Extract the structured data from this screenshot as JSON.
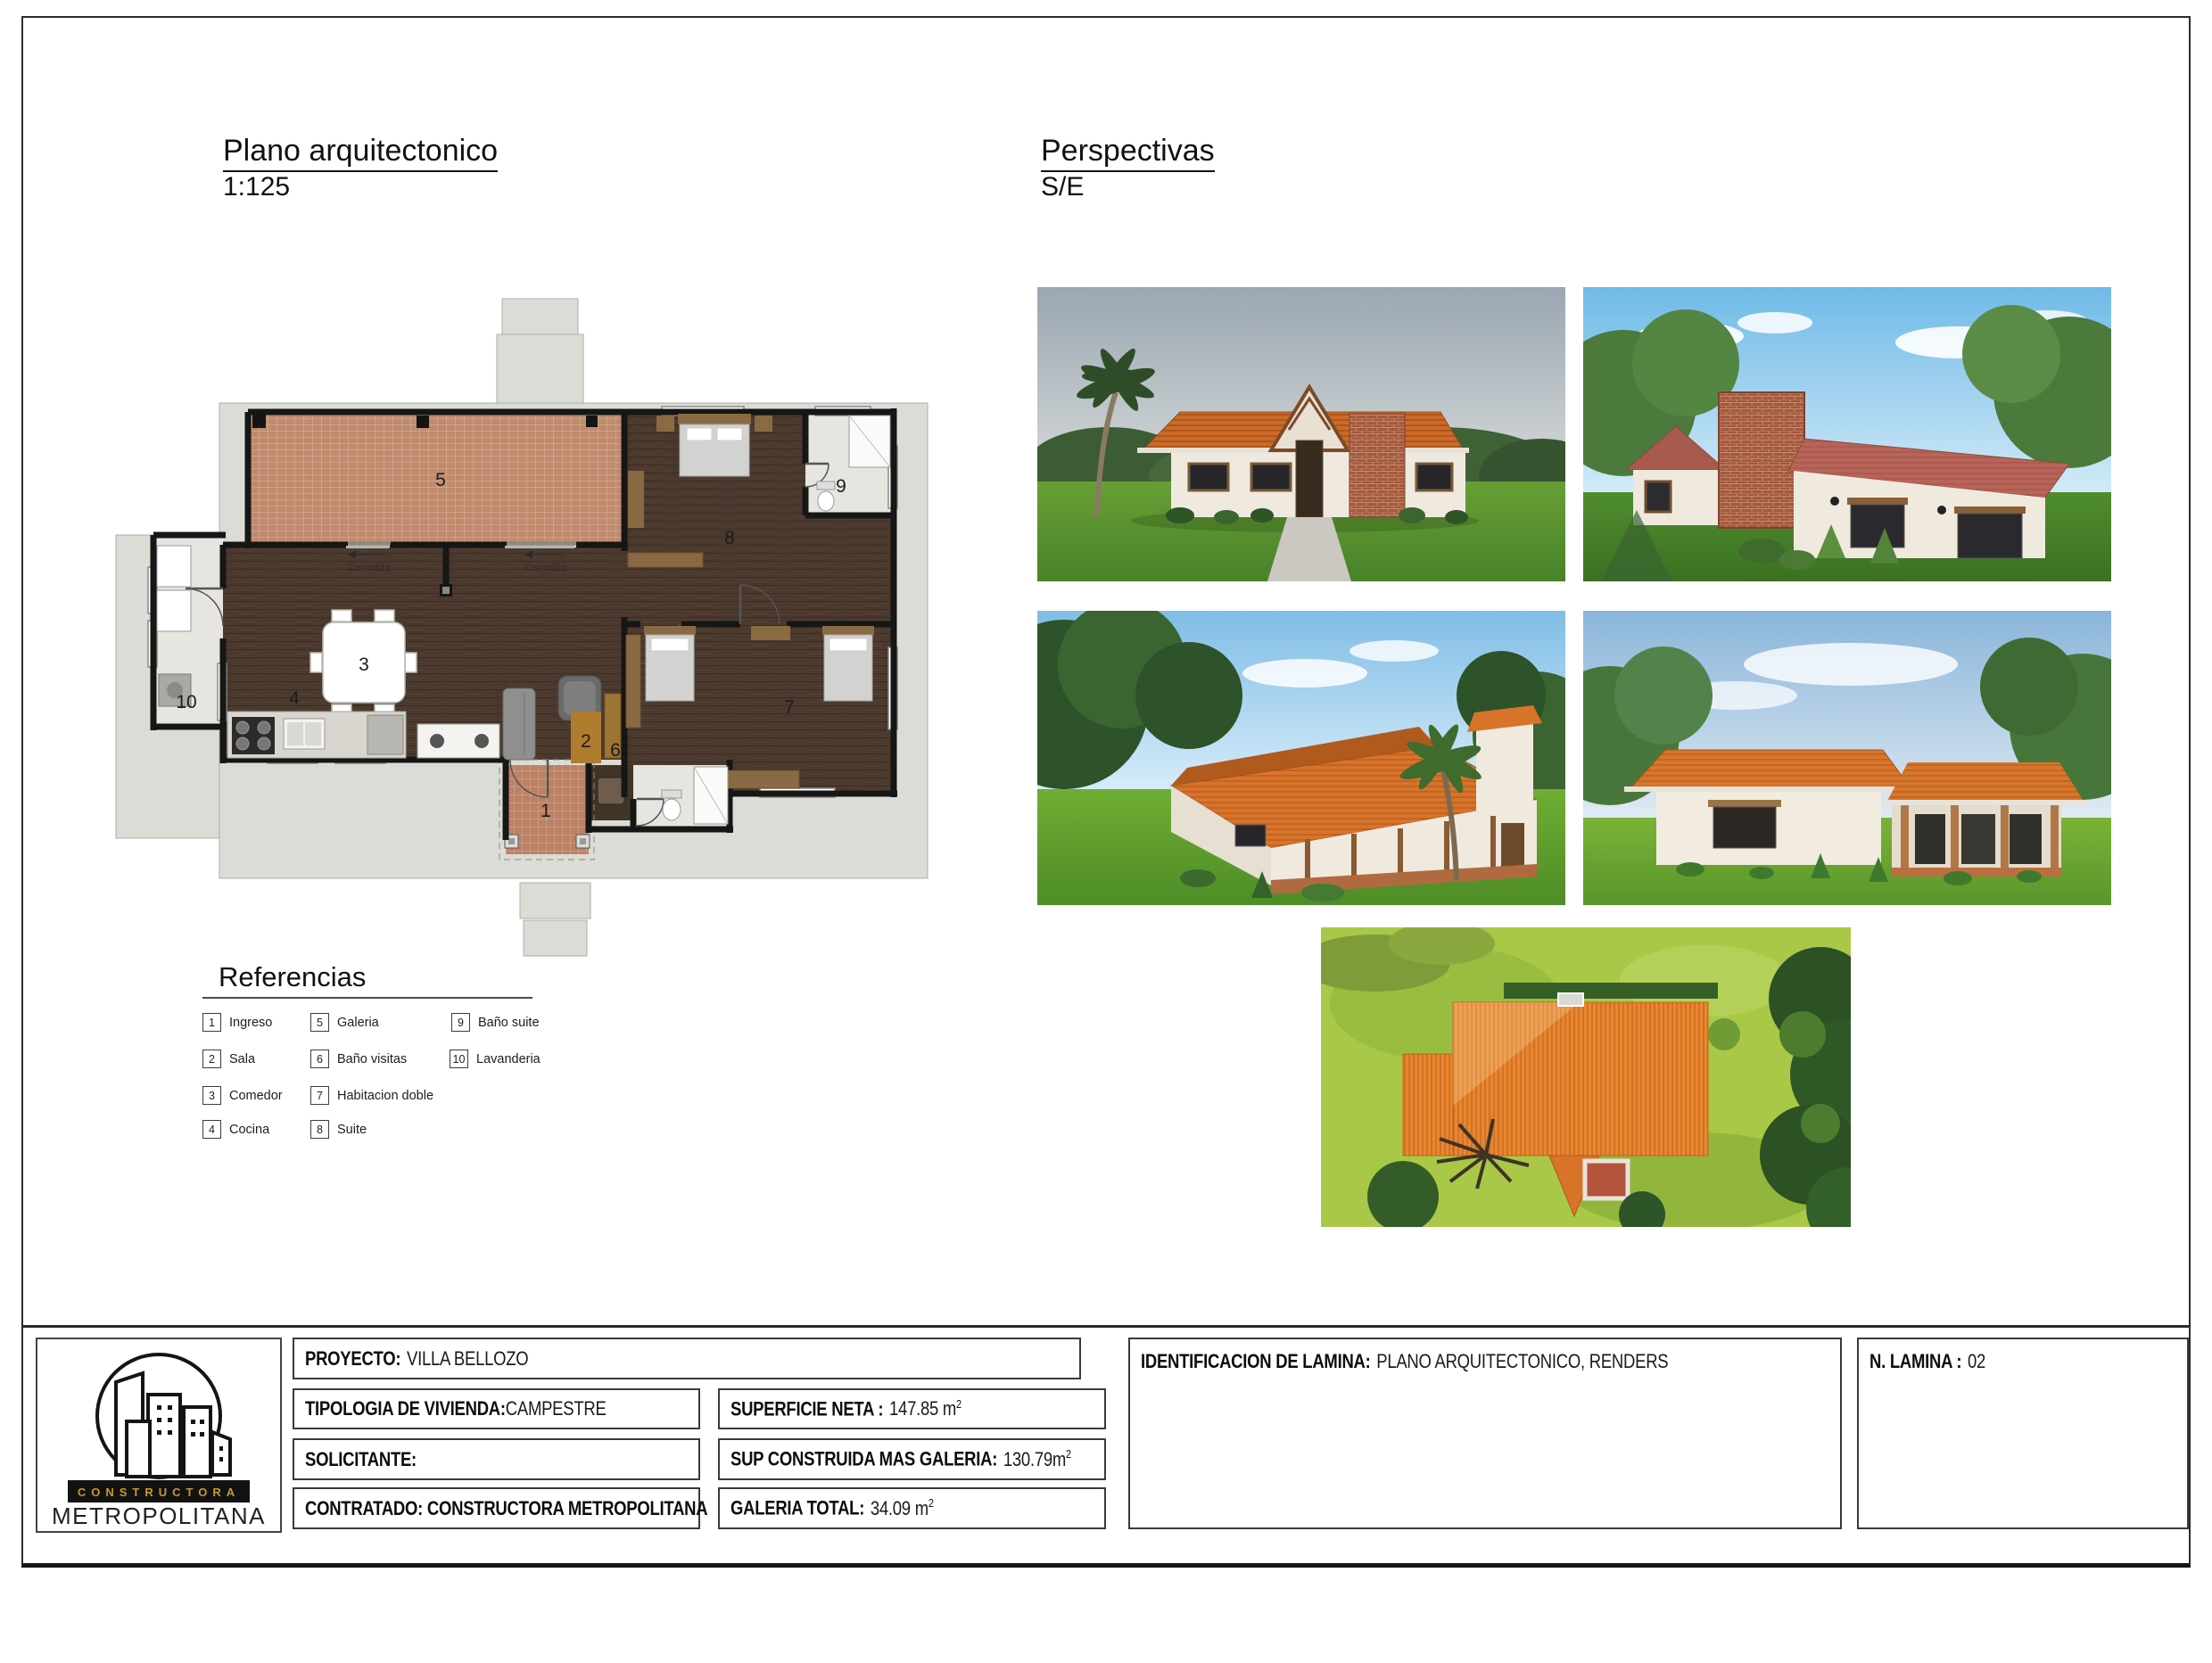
{
  "sheet": {
    "plan": {
      "title": "Plano arquitectonico",
      "scale": "1:125"
    },
    "perspectives": {
      "title": "Perspectivas",
      "scale": "S/E"
    }
  },
  "references": {
    "title": "Referencias",
    "items": [
      {
        "num": "1",
        "label": "Ingreso"
      },
      {
        "num": "2",
        "label": "Sala"
      },
      {
        "num": "3",
        "label": "Comedor"
      },
      {
        "num": "4",
        "label": "Cocina"
      },
      {
        "num": "5",
        "label": "Galeria"
      },
      {
        "num": "6",
        "label": "Baño visitas"
      },
      {
        "num": "7",
        "label": "Habitacion doble"
      },
      {
        "num": "8",
        "label": "Suite"
      },
      {
        "num": "9",
        "label": "Baño suite"
      },
      {
        "num": "10",
        "label": "Lavanderia"
      }
    ]
  },
  "floor_plan": {
    "room_labels": [
      "1",
      "2",
      "3",
      "4",
      "5",
      "6",
      "7",
      "8",
      "9",
      "10"
    ],
    "sliding_door_label": "Corrediza",
    "colors": {
      "galeria_tile": "#c08a6e",
      "wood_floor": "#4c3a2f",
      "concrete_pad": "#dcdcd6",
      "wall": "#161616",
      "bath_floor": "#e7e5e0",
      "roof_orange": "#d8772c"
    }
  },
  "title_block": {
    "logo": {
      "line1": "CONSTRUCTORA",
      "line2": "METROPOLITANA",
      "accent_color": "#c9992e"
    },
    "proyecto": {
      "label": "PROYECTO:",
      "value": "VILLA BELLOZO"
    },
    "tipologia": {
      "label": "TIPOLOGIA DE VIVIENDA:",
      "value": "CAMPESTRE"
    },
    "solicitante": {
      "label": "SOLICITANTE:"
    },
    "contratado": {
      "label": "CONTRATADO: CONSTRUCTORA METROPOLITANA"
    },
    "superficie": {
      "label": "SUPERFICIE NETA :",
      "value": "147.85 m",
      "sup": "2"
    },
    "sup_construida": {
      "label": "SUP CONSTRUIDA MAS  GALERIA:",
      "value": "130.79m",
      "sup": "2"
    },
    "galeria_total": {
      "label": "GALERIA TOTAL:",
      "value": "34.09 m",
      "sup": "2"
    },
    "identificacion": {
      "label": "IDENTIFICACION DE LAMINA:",
      "value": "PLANO ARQUITECTONICO, RENDERS"
    },
    "lamina": {
      "label": "N. LAMINA :",
      "value": "02"
    }
  }
}
